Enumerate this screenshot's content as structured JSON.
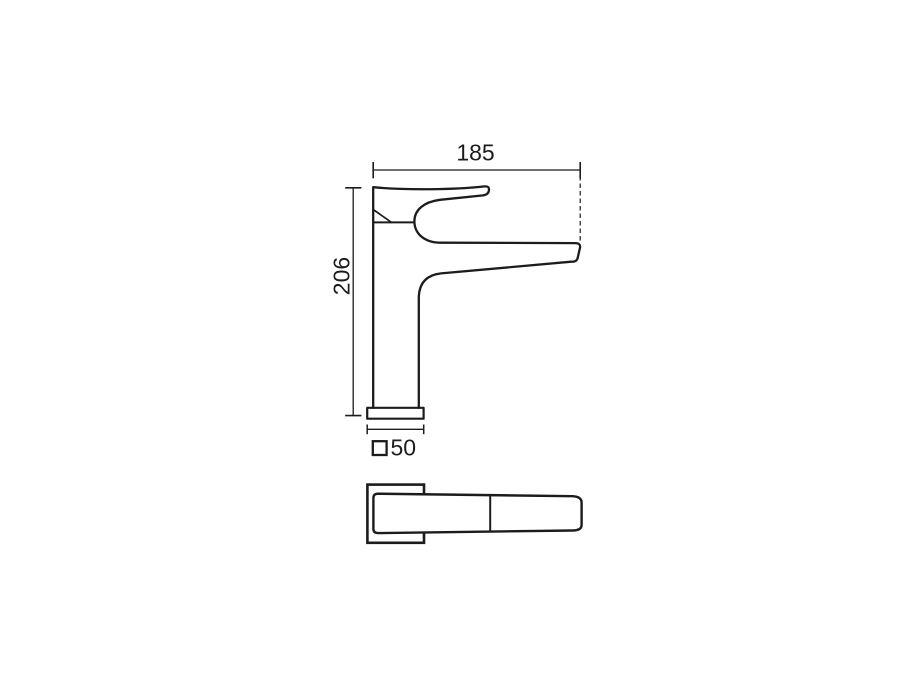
{
  "canvas": {
    "background": "#ffffff",
    "line_color": "#1c1c1c"
  },
  "dimensions": {
    "width": {
      "value": "185"
    },
    "height": {
      "value": "206"
    },
    "base": {
      "symbol": "□",
      "value": "50"
    }
  }
}
